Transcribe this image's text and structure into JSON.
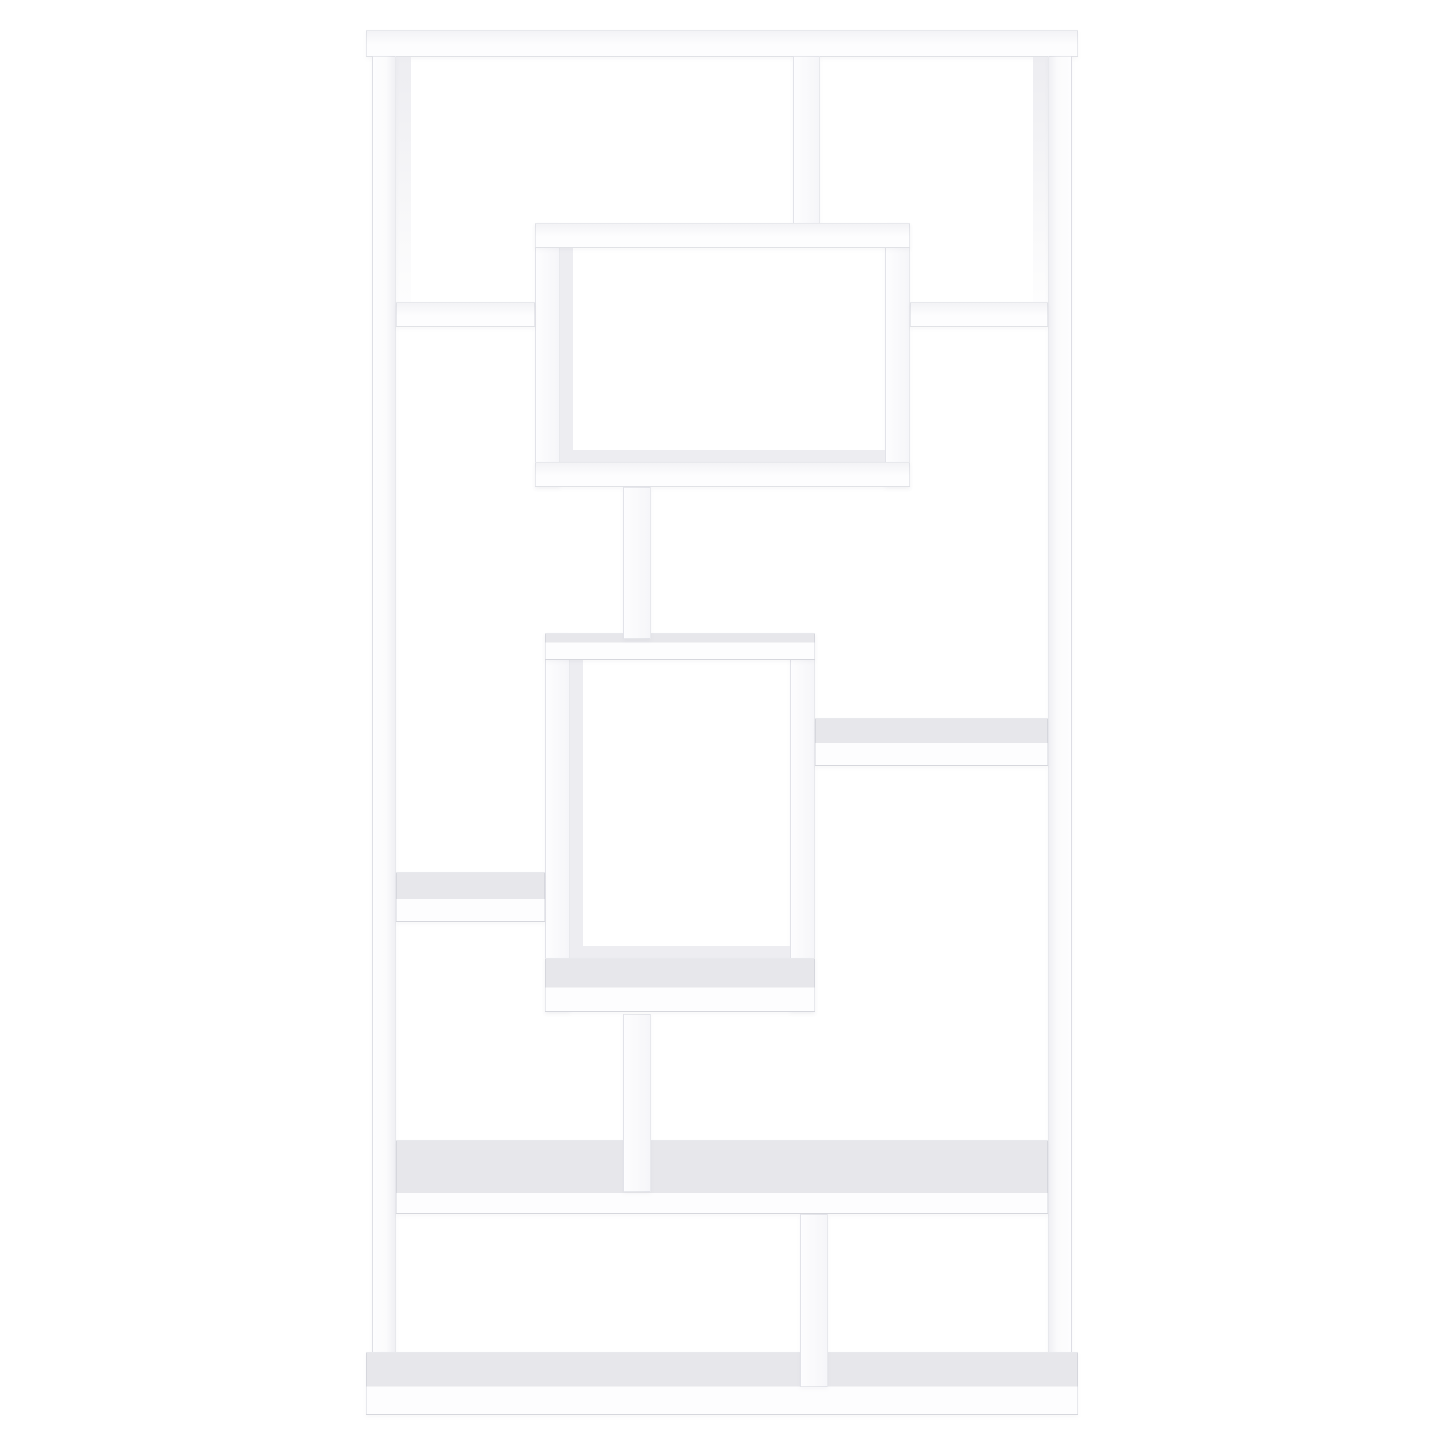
{
  "meta": {
    "image_type": "product-photo",
    "subject": "white geometric cube bookcase with asymmetric open shelves",
    "background_color": "#ffffff",
    "text_content": "none"
  },
  "scene": {
    "canvas": {
      "w": 1445,
      "h": 1445
    },
    "colors": {
      "background": "#ffffff",
      "board_face": "#fdfdfe",
      "board_top_face": "#e7e7eb",
      "inner_face": "#ededf1",
      "edge": "rgba(140,145,160,0.18)"
    },
    "parts": [
      {
        "name": "top-board",
        "kind": "h",
        "x": 366,
        "y": 30,
        "w": 712,
        "h": 27
      },
      {
        "name": "left-panel-inner-face",
        "kind": "faceFade",
        "x": 396,
        "y": 57,
        "w": 15,
        "h": 270
      },
      {
        "name": "right-panel-inner-face",
        "kind": "faceFade",
        "x": 1033,
        "y": 57,
        "w": 15,
        "h": 270
      },
      {
        "name": "left-side-panel",
        "kind": "vpL",
        "x": 372,
        "y": 56,
        "w": 24,
        "h": 1302
      },
      {
        "name": "right-side-panel",
        "kind": "vpR",
        "x": 1048,
        "y": 56,
        "w": 24,
        "h": 1302
      },
      {
        "name": "top-right-divider-post",
        "kind": "v",
        "x": 793,
        "y": 56,
        "w": 27,
        "h": 172
      },
      {
        "name": "upper-cube-left-wall",
        "kind": "v",
        "x": 535,
        "y": 223,
        "w": 25,
        "h": 264
      },
      {
        "name": "upper-cube-right-wall",
        "kind": "v",
        "x": 885,
        "y": 223,
        "w": 25,
        "h": 264
      },
      {
        "name": "upper-cube-inner-left-face",
        "kind": "face",
        "x": 560,
        "y": 248,
        "w": 13,
        "h": 212
      },
      {
        "name": "upper-cube-inner-bottom-face",
        "kind": "face",
        "x": 560,
        "y": 450,
        "w": 325,
        "h": 13
      },
      {
        "name": "upper-cube-top-shelf",
        "kind": "h",
        "x": 535,
        "y": 223,
        "w": 375,
        "h": 25
      },
      {
        "name": "upper-cube-bottom-shelf",
        "kind": "h",
        "x": 535,
        "y": 462,
        "w": 375,
        "h": 25
      },
      {
        "name": "upper-left-side-shelf",
        "kind": "h",
        "x": 396,
        "y": 302,
        "w": 139,
        "h": 25
      },
      {
        "name": "upper-right-side-shelf",
        "kind": "h",
        "x": 910,
        "y": 302,
        "w": 138,
        "h": 25
      },
      {
        "name": "middle-cube-left-wall",
        "kind": "v",
        "x": 545,
        "y": 633,
        "w": 25,
        "h": 379
      },
      {
        "name": "middle-cube-right-wall",
        "kind": "v",
        "x": 790,
        "y": 633,
        "w": 25,
        "h": 379
      },
      {
        "name": "middle-cube-inner-left-face",
        "kind": "face",
        "x": 570,
        "y": 660,
        "w": 13,
        "h": 286
      },
      {
        "name": "middle-cube-inner-bottom-face",
        "kind": "face",
        "x": 570,
        "y": 946,
        "w": 220,
        "h": 12
      },
      {
        "name": "middle-cube-top-shelf",
        "kind": "h2",
        "fold": 0.35,
        "x": 545,
        "y": 633,
        "w": 270,
        "h": 27
      },
      {
        "name": "middle-cube-bottom-shelf",
        "kind": "h2",
        "fold": 0.55,
        "x": 545,
        "y": 958,
        "w": 270,
        "h": 54
      },
      {
        "name": "upper-connector-post",
        "kind": "v",
        "x": 623,
        "y": 487,
        "w": 28,
        "h": 152
      },
      {
        "name": "middle-right-side-shelf",
        "kind": "h2",
        "fold": 0.52,
        "x": 815,
        "y": 718,
        "w": 233,
        "h": 48
      },
      {
        "name": "lower-left-side-shelf",
        "kind": "h2",
        "fold": 0.54,
        "x": 396,
        "y": 872,
        "w": 149,
        "h": 50
      },
      {
        "name": "lower-wide-shelf",
        "kind": "h2",
        "fold": 0.72,
        "x": 396,
        "y": 1140,
        "w": 652,
        "h": 74
      },
      {
        "name": "lower-connector-post",
        "kind": "v",
        "x": 623,
        "y": 1014,
        "w": 28,
        "h": 178
      },
      {
        "name": "bottom-board",
        "kind": "h2",
        "fold": 0.55,
        "x": 366,
        "y": 1352,
        "w": 712,
        "h": 63
      },
      {
        "name": "bottom-divider-post",
        "kind": "v",
        "x": 800,
        "y": 1214,
        "w": 28,
        "h": 173
      }
    ]
  }
}
